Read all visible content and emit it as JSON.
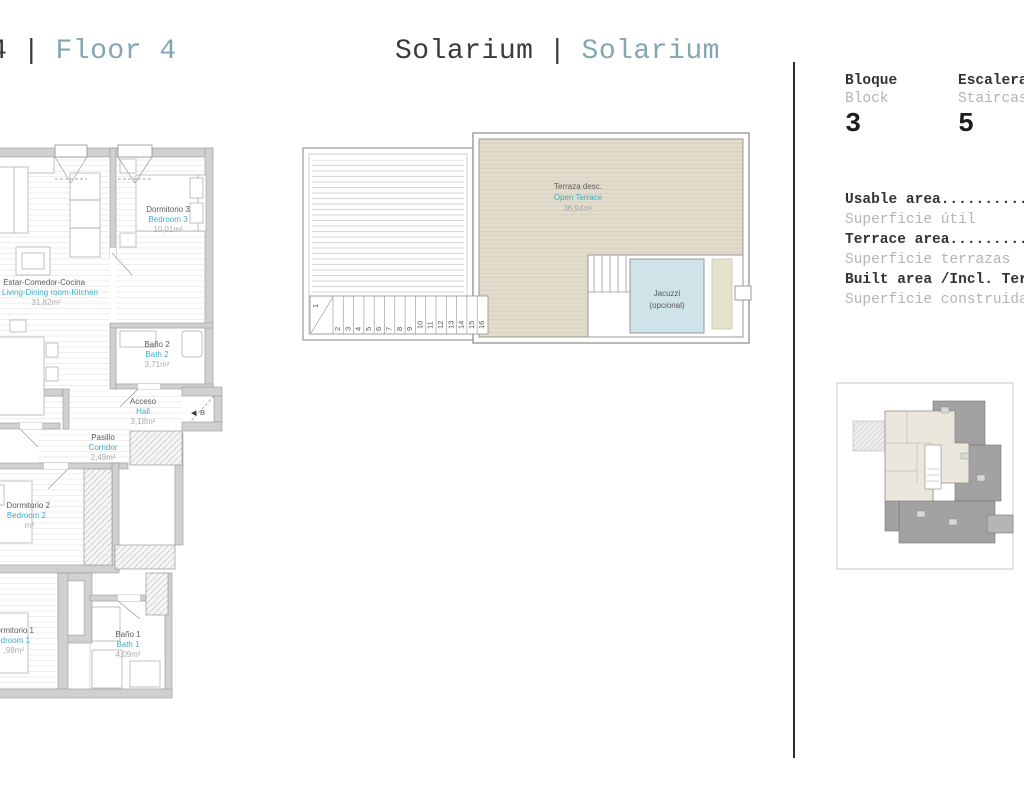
{
  "titles": {
    "left": {
      "prefix": "Planta 4",
      "separator": "|",
      "label": "Floor 4"
    },
    "center": {
      "primary": "Solarium",
      "separator": "|",
      "secondary": "Solarium"
    }
  },
  "info_panel": {
    "block": {
      "es": "Bloque",
      "en": "Block",
      "value": "3"
    },
    "staircase": {
      "es": "Escalera",
      "en": "Staircase",
      "value": "5"
    },
    "areas": [
      {
        "en": "Usable area....................",
        "es": "Superficie útil"
      },
      {
        "en": "Terrace area...................",
        "es": "Superficie terrazas"
      },
      {
        "en": "Built area /Incl. Terrace......",
        "es": "Superficie construida"
      }
    ]
  },
  "floor_plan": {
    "rooms": {
      "bedroom3": {
        "es": "Dormitorio 3",
        "en": "Bedroom 3",
        "area": "10,01m²"
      },
      "living": {
        "es": "Estar-Comedor-Cocina",
        "en": "Living-Dining room-Kitchen",
        "area": "31,82m²"
      },
      "bath2": {
        "es": "Baño 2",
        "en": "Bath 2",
        "area": "3,71m²"
      },
      "hall": {
        "es": "Acceso",
        "en": "Hall",
        "area": "3,18m²"
      },
      "corridor": {
        "es": "Pasillo",
        "en": "Corridor",
        "area": "2,49m²"
      },
      "bedroom2": {
        "es": "Dormitorio 2",
        "en": "Bedroom 2",
        "area": "m²"
      },
      "bedroom1": {
        "es": "Dormitorio 1",
        "en": "Bedroom 1",
        "area": ",98m²"
      },
      "bath1": {
        "es": "Baño 1",
        "en": "Bath 1",
        "area": "4,09m²"
      }
    },
    "entrance_marker": {
      "icon": "◀",
      "label": "B"
    }
  },
  "solarium_plan": {
    "terrace": {
      "es": "Terraza desc.",
      "en": "Open Terrace",
      "area": "36,94m²"
    },
    "jacuzzi": {
      "line1": "Jacuzzi",
      "line2": "(opcional)"
    },
    "stairs": [
      "1",
      "2",
      "3",
      "4",
      "5",
      "6",
      "7",
      "8",
      "9",
      "10",
      "11",
      "12",
      "13",
      "14",
      "15",
      "16"
    ]
  },
  "colors": {
    "accent_teal": "#82a7b1",
    "label_teal": "#3fafc2",
    "terrace_beige": "#e2dccd",
    "jacuzzi_blue": "#cfe3e8"
  }
}
